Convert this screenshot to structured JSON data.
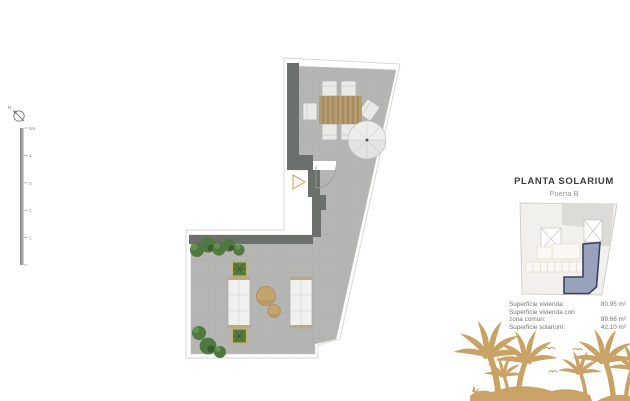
{
  "title_block": {
    "title": "PLANTA SOLARIUM",
    "subtitle": "Puerta B"
  },
  "area_table": {
    "rows": [
      {
        "label": "Superficie vivienda:",
        "value": "80.95 m²"
      },
      {
        "label": "Superficie vivienda con",
        "value": ""
      },
      {
        "label": "zona comun:",
        "value": "89.66 m²"
      },
      {
        "label": "Superficie solarium:",
        "value": "42.10 m²"
      }
    ]
  },
  "scale_bar": {
    "labels": [
      "5m",
      "4",
      "3",
      "2",
      "1"
    ]
  },
  "compass": {
    "label": "N"
  },
  "icons": {
    "north_compass": "north-arrow",
    "entry_marker": "entry-triangle",
    "birds": "seagull-silhouettes",
    "palms": "palm-tree-silhouettes"
  },
  "colors": {
    "floor": "#b5b5b3",
    "wall": "#6b706d",
    "wood": "#b59b70",
    "accent_tan": "#c9a265",
    "plant_green": "#4e7a40",
    "highlight_fill": "#98a2bd",
    "highlight_stroke": "#39445f"
  }
}
